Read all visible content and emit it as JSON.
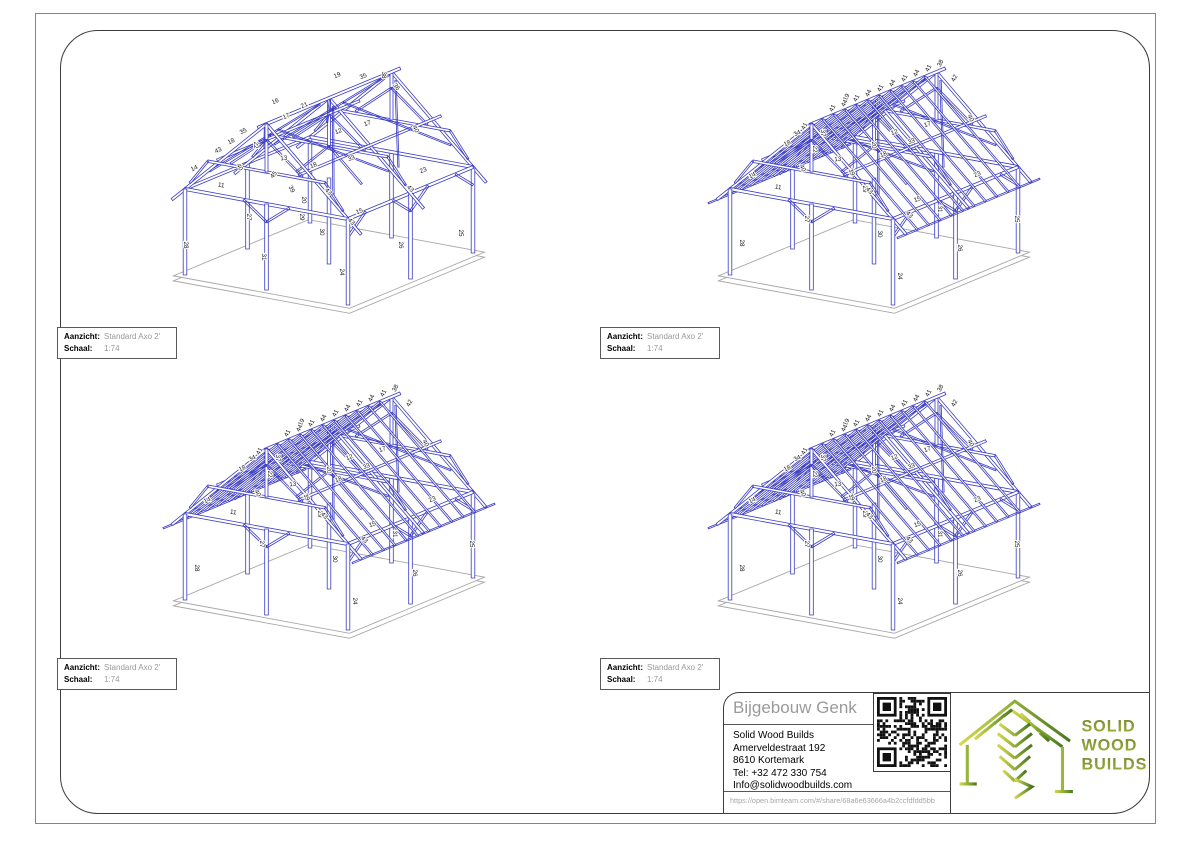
{
  "sheet": {
    "border_color": "#3c3c3c",
    "page_border_color": "#7b7bca",
    "background": "#ffffff"
  },
  "views": [
    {
      "name": "top-left",
      "type": "frame",
      "info": {
        "aanzicht_label": "Aanzicht:",
        "aanzicht_value": "Standard Axo 2'",
        "schaal_label": "Schaal:",
        "schaal_value": "1:74"
      }
    },
    {
      "name": "top-right",
      "type": "roof",
      "info": {
        "aanzicht_label": "Aanzicht:",
        "aanzicht_value": "Standard Axo 2'",
        "schaal_label": "Schaal:",
        "schaal_value": "1:74"
      }
    },
    {
      "name": "bottom-left",
      "type": "roof",
      "info": {
        "aanzicht_label": "Aanzicht:",
        "aanzicht_value": "Standard Axo 2'",
        "schaal_label": "Schaal:",
        "schaal_value": "1:74"
      }
    },
    {
      "name": "bottom-right",
      "type": "roof",
      "info": {
        "aanzicht_label": "Aanzicht:",
        "aanzicht_value": "Standard Axo 2'",
        "schaal_label": "Schaal:",
        "schaal_value": "1:74"
      }
    }
  ],
  "drawing": {
    "line_color": "#3b3bc2",
    "thin_line_color": "#5050cc",
    "slab_color": "#a8a8a8",
    "label_color": "#161616"
  },
  "member_labels": {
    "frame": [
      {
        "t": "14",
        "x": 40,
        "y": 122,
        "r": -26
      },
      {
        "t": "18",
        "x": 77,
        "y": 95,
        "r": -26
      },
      {
        "t": "35",
        "x": 89,
        "y": 85,
        "r": -26
      },
      {
        "t": "43",
        "x": 64,
        "y": 104,
        "r": -26
      },
      {
        "t": "22",
        "x": 99,
        "y": 97,
        "r": 90
      },
      {
        "t": "40",
        "x": 83,
        "y": 120,
        "r": 62
      },
      {
        "t": "16",
        "x": 121,
        "y": 55,
        "r": -24
      },
      {
        "t": "17",
        "x": 132,
        "y": 70,
        "r": -24
      },
      {
        "t": "21",
        "x": 150,
        "y": 59,
        "r": -24
      },
      {
        "t": "19",
        "x": 183,
        "y": 29,
        "r": -24
      },
      {
        "t": "35",
        "x": 209,
        "y": 30,
        "r": -24
      },
      {
        "t": "38",
        "x": 227,
        "y": 27,
        "r": 90
      },
      {
        "t": "36",
        "x": 240,
        "y": 40,
        "r": 52
      },
      {
        "t": "12",
        "x": 184,
        "y": 85,
        "r": -21
      },
      {
        "t": "17",
        "x": 213,
        "y": 77,
        "r": -21
      },
      {
        "t": "13",
        "x": 129,
        "y": 112,
        "r": -6
      },
      {
        "t": "18",
        "x": 159,
        "y": 119,
        "r": -21
      },
      {
        "t": "33",
        "x": 197,
        "y": 112,
        "r": -21
      },
      {
        "t": "40",
        "x": 259,
        "y": 82,
        "r": 62
      },
      {
        "t": "39",
        "x": 135,
        "y": 142,
        "r": 62
      },
      {
        "t": "20",
        "x": 147,
        "y": 152,
        "r": 90
      },
      {
        "t": "43",
        "x": 172,
        "y": 145,
        "r": 45
      },
      {
        "t": "15",
        "x": 205,
        "y": 165,
        "r": -21
      },
      {
        "t": "43",
        "x": 195,
        "y": 175,
        "r": 45
      },
      {
        "t": "23",
        "x": 269,
        "y": 124,
        "r": -24
      },
      {
        "t": "43",
        "x": 254,
        "y": 142,
        "r": 45
      },
      {
        "t": "11",
        "x": 66,
        "y": 139,
        "r": 8
      },
      {
        "t": "27",
        "x": 92,
        "y": 169,
        "r": 90
      },
      {
        "t": "31",
        "x": 107,
        "y": 209,
        "r": 90
      },
      {
        "t": "29",
        "x": 145,
        "y": 169,
        "r": 90
      },
      {
        "t": "30",
        "x": 165,
        "y": 184,
        "r": 90
      },
      {
        "t": "24",
        "x": 185,
        "y": 224,
        "r": 90
      },
      {
        "t": "26",
        "x": 244,
        "y": 197,
        "r": 90
      },
      {
        "t": "25",
        "x": 304,
        "y": 185,
        "r": 90
      },
      {
        "t": "28",
        "x": 29,
        "y": 197,
        "r": 90
      },
      {
        "t": "45",
        "x": 120,
        "y": 128,
        "r": -50
      }
    ],
    "roof": [
      {
        "t": "14",
        "x": 53,
        "y": 129,
        "r": -26
      },
      {
        "t": "18",
        "x": 88,
        "y": 97,
        "r": -26
      },
      {
        "t": "34",
        "x": 98,
        "y": 87,
        "r": -26
      },
      {
        "t": "41",
        "x": 106,
        "y": 79,
        "r": -62
      },
      {
        "t": "22",
        "x": 113,
        "y": 101,
        "r": 90
      },
      {
        "t": "37",
        "x": 121,
        "y": 85,
        "r": 90
      },
      {
        "t": "40",
        "x": 101,
        "y": 121,
        "r": 62
      },
      {
        "t": "13",
        "x": 138,
        "y": 113,
        "r": -6
      },
      {
        "t": "39",
        "x": 150,
        "y": 125,
        "r": 62
      },
      {
        "t": "29",
        "x": 163,
        "y": 141,
        "r": 90
      },
      {
        "t": "11",
        "x": 78,
        "y": 141,
        "r": 8
      },
      {
        "t": "27",
        "x": 105,
        "y": 171,
        "r": 90
      },
      {
        "t": "28",
        "x": 40,
        "y": 195,
        "r": 90
      },
      {
        "t": "31",
        "x": 238,
        "y": 161,
        "r": 90
      },
      {
        "t": "30",
        "x": 178,
        "y": 186,
        "r": 90
      },
      {
        "t": "24",
        "x": 198,
        "y": 228,
        "r": 90
      },
      {
        "t": "26",
        "x": 258,
        "y": 200,
        "r": 90
      },
      {
        "t": "25",
        "x": 315,
        "y": 171,
        "r": 90
      },
      {
        "t": "23",
        "x": 278,
        "y": 128,
        "r": -24
      },
      {
        "t": "43",
        "x": 208,
        "y": 168,
        "r": 45
      },
      {
        "t": "43",
        "x": 168,
        "y": 144,
        "r": 45
      },
      {
        "t": "15",
        "x": 218,
        "y": 153,
        "r": -21
      },
      {
        "t": "12",
        "x": 195,
        "y": 86,
        "r": -21
      },
      {
        "t": "33",
        "x": 212,
        "y": 95,
        "r": -21
      },
      {
        "t": "17",
        "x": 228,
        "y": 78,
        "r": -21
      },
      {
        "t": "42",
        "x": 256,
        "y": 31,
        "r": -62
      },
      {
        "t": "40",
        "x": 269,
        "y": 71,
        "r": 62
      },
      {
        "t": "19",
        "x": 148,
        "y": 50,
        "r": -62
      },
      {
        "t": "20",
        "x": 172,
        "y": 97,
        "r": 90
      },
      {
        "t": "18",
        "x": 184,
        "y": 108,
        "r": -21
      },
      {
        "t": "41",
        "x": 134,
        "y": 61,
        "r": -62
      },
      {
        "t": "44",
        "x": 146,
        "y": 56,
        "r": -62
      },
      {
        "t": "41",
        "x": 158,
        "y": 51,
        "r": -62
      },
      {
        "t": "44",
        "x": 170,
        "y": 46,
        "r": -62
      },
      {
        "t": "41",
        "x": 182,
        "y": 41,
        "r": -62
      },
      {
        "t": "44",
        "x": 194,
        "y": 36,
        "r": -62
      },
      {
        "t": "41",
        "x": 206,
        "y": 31,
        "r": -62
      },
      {
        "t": "44",
        "x": 218,
        "y": 26,
        "r": -62
      },
      {
        "t": "41",
        "x": 230,
        "y": 21,
        "r": -62
      },
      {
        "t": "38",
        "x": 242,
        "y": 16,
        "r": -62
      }
    ]
  },
  "title_block": {
    "project_title": "Bijgebouw Genk",
    "company": "Solid Wood Builds",
    "address_line1": "Amerveldestraat 192",
    "address_line2": "8610 Kortemark",
    "phone": "Tel: +32 472 330 754",
    "email": "Info@solidwoodbuilds.com",
    "share_url": "https://open.bimteam.com/#/share/68a6e63666a4b2ccfdfdd5bb"
  },
  "logo": {
    "line1": "SOLID",
    "line2": "WOOD",
    "line3": "BUILDS",
    "gradient_start": "#d6d84c",
    "gradient_mid": "#8fae38",
    "gradient_end": "#47761e",
    "text_color_start": "#76882e",
    "text_color_end": "#a3b542"
  }
}
